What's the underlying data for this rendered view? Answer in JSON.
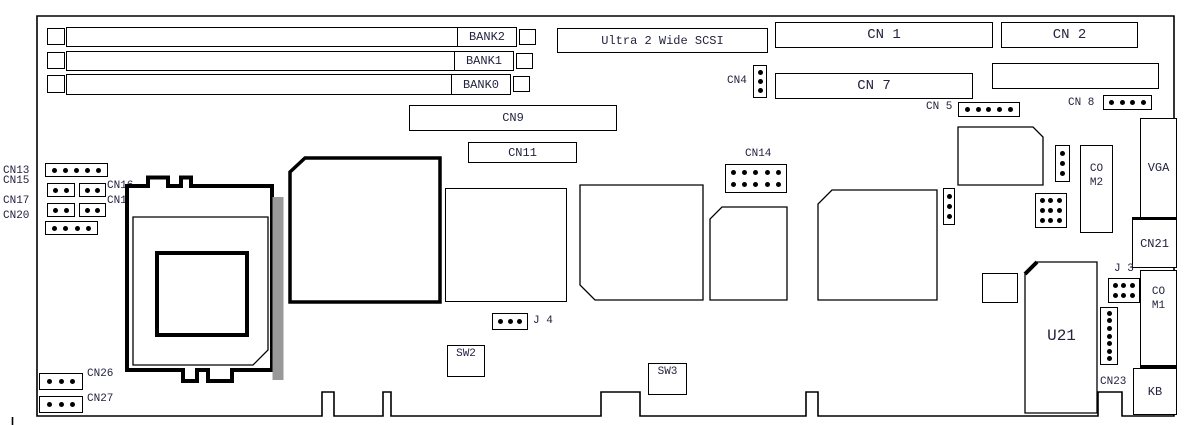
{
  "labels": {
    "bank2": "BANK2",
    "bank1": "BANK1",
    "bank0": "BANK0",
    "scsi": "Ultra 2 Wide SCSI",
    "cn1": "CN 1",
    "cn2": "CN 2",
    "cn4": "CN4",
    "cn5": "CN 5",
    "cn7": "CN 7",
    "cn8": "CN 8",
    "cn9": "CN9",
    "cn11": "CN11",
    "cn13": "CN13",
    "cn14": "CN14",
    "cn15": "CN15",
    "cn16": "CN16",
    "cn17": "CN17",
    "cn18": "CN18",
    "cn20": "CN20",
    "cn21": "CN21",
    "cn23": "CN23",
    "cn26": "CN26",
    "cn27": "CN27",
    "j3": "J 3",
    "j4": "J 4",
    "sw2": "SW2",
    "sw3": "SW3",
    "u21": "U21",
    "vga": "VGA",
    "kb": "KB",
    "com1_line1": "CO",
    "com1_line2": "M1",
    "com2_line1": "CO",
    "com2_line2": "M2"
  },
  "pin_headers": {
    "cn13": 5,
    "cn15": 2,
    "cn16": 2,
    "cn17": 2,
    "cn18": 2,
    "cn20": 4,
    "cn26": 3,
    "cn27": 3,
    "cn4": 3,
    "cn5": 5,
    "cn8": 4,
    "cn14": 10,
    "j4": 3,
    "j3": 6,
    "cn23": 7,
    "unlabeled_3x3": 9,
    "unlabeled_v3_left": 3,
    "unlabeled_v3_right": 3
  },
  "colors": {
    "line": "#000000",
    "text": "#23233f",
    "socket_bar": "#999999",
    "background": "#ffffff"
  }
}
